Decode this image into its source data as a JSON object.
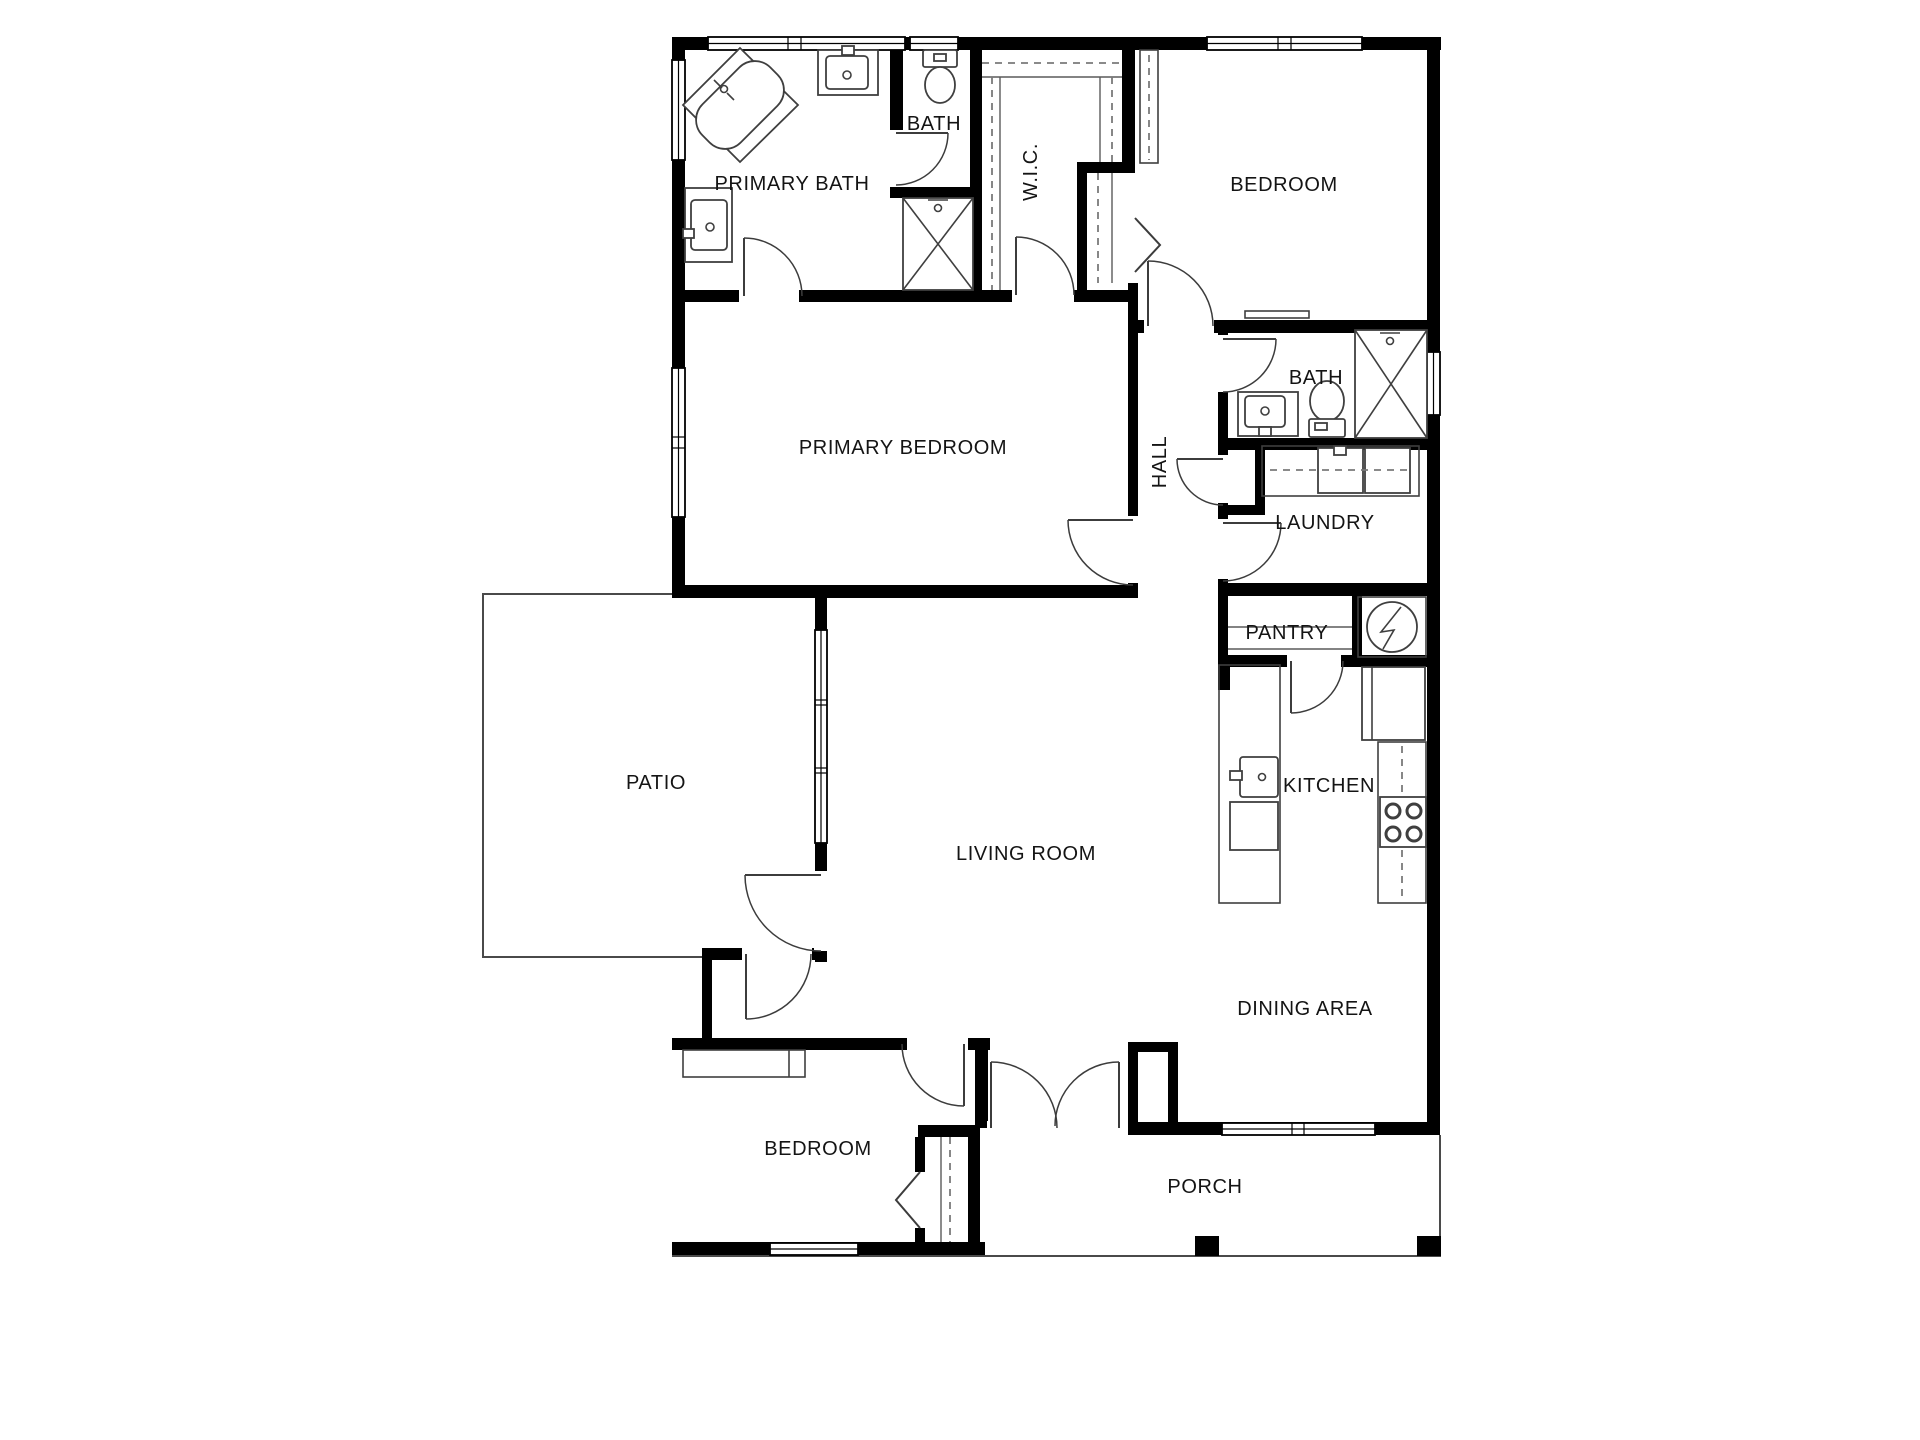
{
  "title": "House floor plan",
  "colors": {
    "wall": "#000000",
    "background": "#ffffff",
    "fixture_line": "#3f3f3f",
    "label_text": "#141414"
  },
  "rooms": [
    {
      "id": "primary-bath",
      "label": "PRIMARY BATH"
    },
    {
      "id": "bath-top",
      "label": "BATH"
    },
    {
      "id": "wic",
      "label": "W.I.C."
    },
    {
      "id": "bedroom-top",
      "label": "BEDROOM"
    },
    {
      "id": "primary-bedroom",
      "label": "PRIMARY BEDROOM"
    },
    {
      "id": "hall",
      "label": "HALL"
    },
    {
      "id": "bath-right",
      "label": "BATH"
    },
    {
      "id": "laundry",
      "label": "LAUNDRY"
    },
    {
      "id": "pantry",
      "label": "PANTRY"
    },
    {
      "id": "patio",
      "label": "PATIO"
    },
    {
      "id": "kitchen",
      "label": "KITCHEN"
    },
    {
      "id": "living-room",
      "label": "LIVING ROOM"
    },
    {
      "id": "dining-area",
      "label": "DINING AREA"
    },
    {
      "id": "bedroom-bottom",
      "label": "BEDROOM"
    },
    {
      "id": "porch",
      "label": "PORCH"
    }
  ],
  "fixtures": [
    "corner-bathtub",
    "vanity-sink",
    "toilet",
    "shower",
    "washer",
    "dryer",
    "water-heater",
    "kitchen-sink",
    "dishwasher",
    "refrigerator",
    "stove",
    "closet-rod",
    "bifold-door",
    "french-doors",
    "porch-post",
    "wardrobe",
    "shelf"
  ]
}
